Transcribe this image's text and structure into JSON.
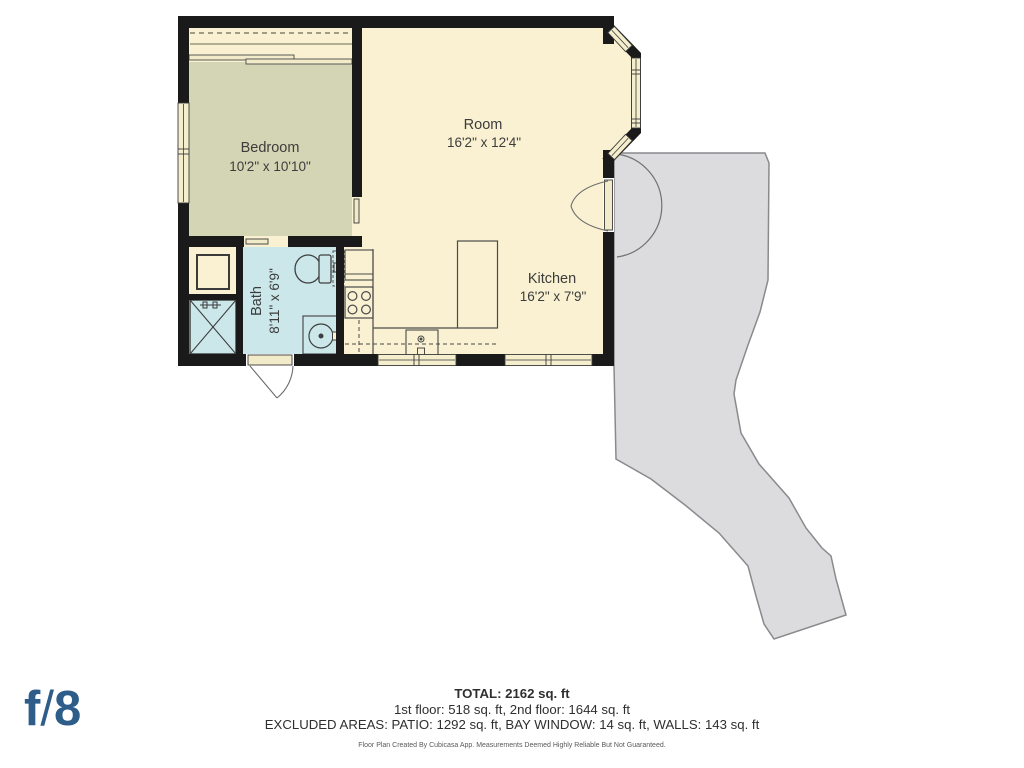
{
  "floorplan": {
    "rooms": [
      {
        "name": "Bedroom",
        "dims": "10'2\" x 10'10\""
      },
      {
        "name": "Room",
        "dims": "16'2\" x 12'4\""
      },
      {
        "name": "Kitchen",
        "dims": "16'2\" x 7'9\""
      },
      {
        "name": "Bath",
        "dims": "8'11\" x 6'9\""
      }
    ],
    "colors": {
      "wall": "#1a1a1a",
      "floor_cream": "#f9f1d1",
      "bedroom_sage": "#d4d5b4",
      "bath_blue": "#cbe7ea",
      "patio_gray": "#dcdcde",
      "patio_border": "#8a8a8d",
      "logo_blue": "#2d5d88"
    }
  },
  "footer": {
    "total": "TOTAL: 2162 sq. ft",
    "floors": "1st floor: 518 sq. ft, 2nd floor: 1644 sq. ft",
    "excluded": "EXCLUDED AREAS: PATIO: 1292 sq. ft, BAY WINDOW: 14 sq. ft, WALLS: 143 sq. ft",
    "disclaimer": "Floor Plan Created By Cubicasa App. Measurements Deemed Highly Reliable But Not Guaranteed."
  },
  "logo": {
    "f": "f",
    "slash": "/",
    "eight": "8"
  }
}
